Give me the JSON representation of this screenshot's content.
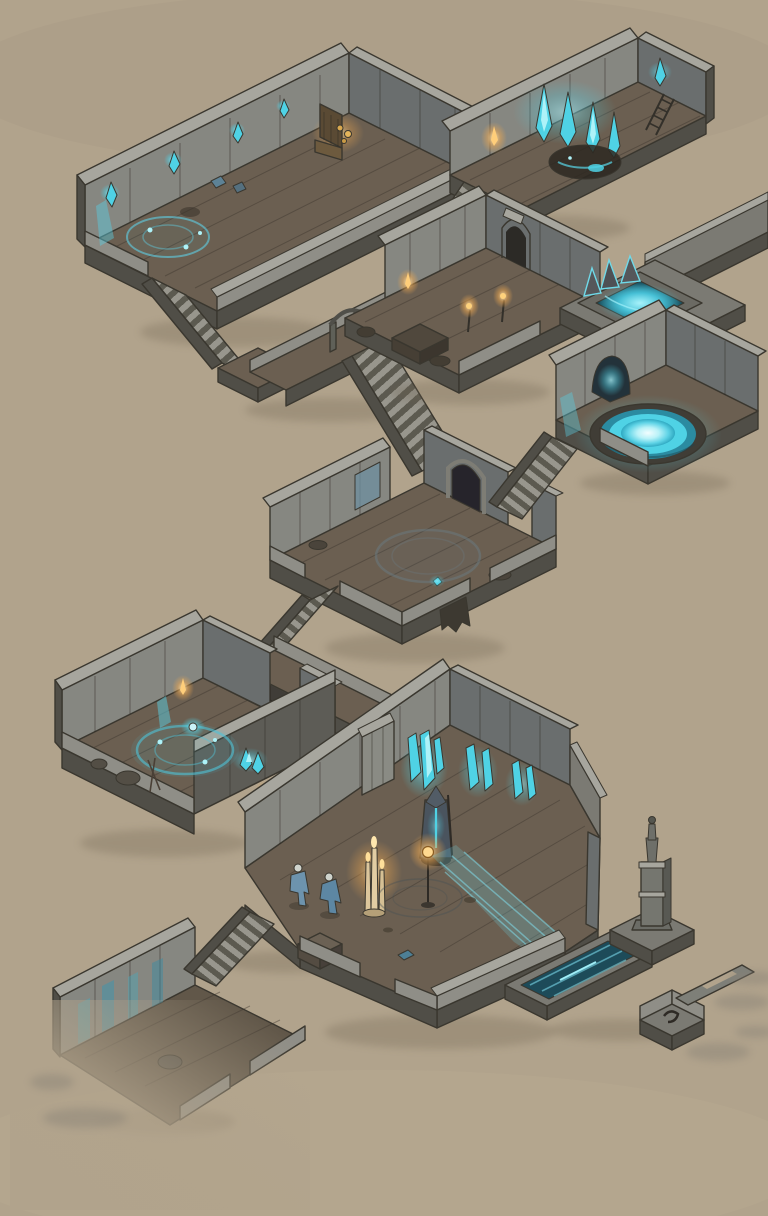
{
  "scene": {
    "type": "isometric-dungeon-map",
    "style": "hand-drawn ink and watercolor on tan paper",
    "lighting": [
      "cyan-crystal-glow",
      "orange-torch-glow"
    ]
  },
  "palette": {
    "background": "#b1a38c",
    "wall_lit": "#868781",
    "wall_shadow": "#6a6e6e",
    "wall_front": "#5d5c56",
    "wall_cap": "#a7a69e",
    "slab_side": "#504e47",
    "parapet": "#8f8e87",
    "stone": "#7b7a73",
    "floor": "#6b5f51",
    "floor_dark": "#615749",
    "ink": "#3a372f",
    "glow_cyan": "#4fd2e5",
    "glow_cyan_deep": "#2596ad",
    "pool_core": "#eafcfd",
    "water_dark": "#1d4b59",
    "ember": "#eda94c",
    "ember_bright": "#ffdf9a",
    "gold": "#c08a3c",
    "wood_dark": "#5a4a34",
    "figure_blue": "#5d87a3",
    "paper_shadow": "#6e6250"
  },
  "rooms": [
    {
      "id": "throne-room",
      "label": "Throne Room (top left)",
      "features": [
        "wall-crystals",
        "cyan-wall-streak",
        "floor-ritual-circle",
        "gold-throne",
        "treasure-glint",
        "floor-debris",
        "long-staircase-exit"
      ]
    },
    {
      "id": "crystal-chamber",
      "label": "Crystal Chamber (top right)",
      "features": [
        "glowing-crystal-wall",
        "wall-torch",
        "dark-floor-sigil",
        "ladder",
        "twin-diverging-staircases"
      ]
    },
    {
      "id": "shrine-room",
      "label": "Shrine Room (middle)",
      "features": [
        "stone-arch-doorway",
        "wall-torch",
        "standing-torches",
        "table",
        "walkway-arch-gate"
      ]
    },
    {
      "id": "waterfall-basin",
      "label": "Waterfall Basin",
      "features": [
        "sunken-cyan-pool",
        "rock-rim",
        "corridor-to-upper-right"
      ]
    },
    {
      "id": "portal-pool-room",
      "label": "Portal Pool Room",
      "features": [
        "glowing-circular-pool",
        "cave-arch",
        "cyan-waterfall-streak",
        "staircase-to-central-hall"
      ]
    },
    {
      "id": "central-hall",
      "label": "Central Hall",
      "features": [
        "faded-floor-circle",
        "arched-alcove",
        "blue-wall-panel",
        "hanging-banner",
        "cyan-gem",
        "debris",
        "staircase-down"
      ]
    },
    {
      "id": "ritual-room",
      "label": "Ritual Room (lower left)",
      "features": [
        "blue-ritual-circle",
        "glow-orb",
        "crystal-cluster",
        "wall-torch",
        "cyan-wall-streak",
        "boulders"
      ]
    },
    {
      "id": "great-hall",
      "label": "Great Hall",
      "features": [
        "two-cloaked-figures",
        "melted-candle-stand",
        "glowing-lantern-post",
        "robed-statue-with-cyan-glow",
        "hanging-crystal-curtains",
        "wall-buttress-pillar",
        "water-stream",
        "crate",
        "blue-chest"
      ]
    },
    {
      "id": "lower-chamber",
      "label": "Lower Chamber (bottom left)",
      "features": [
        "blue-stained-wall",
        "small-staircase",
        "boulder",
        "parapet-ledges",
        "fading-sketch-edge"
      ]
    },
    {
      "id": "water-channel-wing",
      "label": "Water Channel Wing (bottom right)",
      "features": [
        "sunken-water-trough",
        "obelisk-tower",
        "tower-platform",
        "walled-platform-with-hook-mark",
        "slotted-bridge-slab",
        "fading-sketch-streaks"
      ]
    }
  ]
}
